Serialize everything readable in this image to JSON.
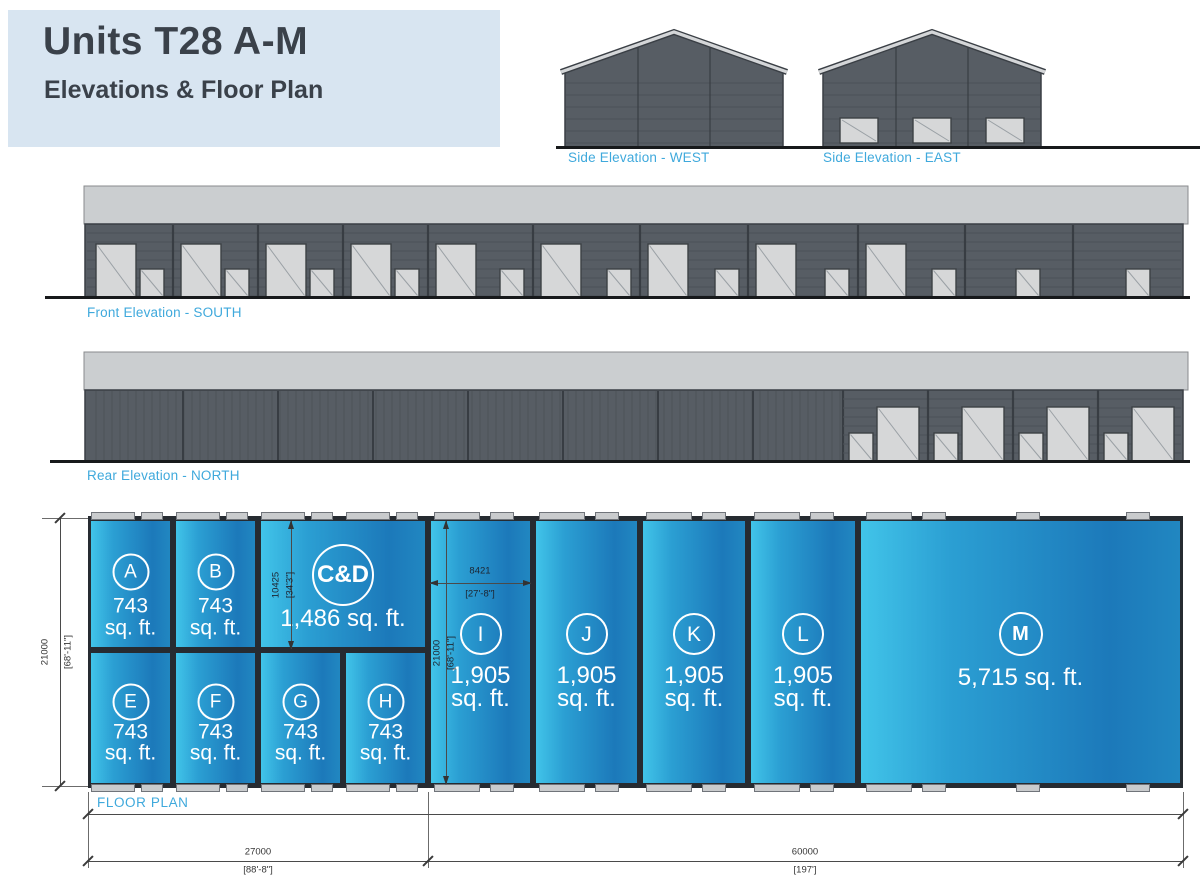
{
  "title": {
    "heading": "Units T28 A-M",
    "subheading": "Elevations & Floor Plan"
  },
  "elevations": {
    "side_west_label": "Side Elevation - WEST",
    "side_east_label": "Side Elevation - EAST",
    "front_label": "Front Elevation - SOUTH",
    "rear_label": "Rear Elevation - NORTH"
  },
  "floor_plan": {
    "label": "FLOOR PLAN",
    "units": [
      {
        "id": "A",
        "label": "A",
        "area": "743",
        "area2": "sq. ft."
      },
      {
        "id": "B",
        "label": "B",
        "area": "743",
        "area2": "sq. ft."
      },
      {
        "id": "CD",
        "label": "C&D",
        "area": "1,486 sq. ft."
      },
      {
        "id": "E",
        "label": "E",
        "area": "743",
        "area2": "sq. ft."
      },
      {
        "id": "F",
        "label": "F",
        "area": "743",
        "area2": "sq. ft."
      },
      {
        "id": "G",
        "label": "G",
        "area": "743",
        "area2": "sq. ft."
      },
      {
        "id": "H",
        "label": "H",
        "area": "743",
        "area2": "sq. ft."
      },
      {
        "id": "I",
        "label": "I",
        "area": "1,905",
        "area2": "sq. ft."
      },
      {
        "id": "J",
        "label": "J",
        "area": "1,905",
        "area2": "sq. ft."
      },
      {
        "id": "K",
        "label": "K",
        "area": "1,905",
        "area2": "sq. ft."
      },
      {
        "id": "L",
        "label": "L",
        "area": "1,905",
        "area2": "sq. ft."
      },
      {
        "id": "M",
        "label": "M",
        "area": "5,715 sq. ft."
      }
    ],
    "dimensions": {
      "left_height_mm": "21000",
      "left_height_ft": "[68'-11\"]",
      "cd_depth_mm": "10425",
      "cd_depth_ft": "[34'3\"]",
      "unit_i_width_mm": "8421",
      "unit_i_width_ft": "[27'-8\"]",
      "unit_i_height_mm": "21000",
      "unit_i_height_ft": "[68'-11\"]",
      "left_block_mm": "27000",
      "left_block_ft": "[88'-8\"]",
      "right_block_mm": "60000",
      "right_block_ft": "[197']"
    }
  },
  "colors": {
    "accent": "#3fa9dc",
    "title_bg": "#d8e5f1",
    "title_text": "#3a414a",
    "wall_mid": "#575d64",
    "wall_edge": "#3a3f45",
    "siding": "#4b5157",
    "joint": "#383d43",
    "fascia": "#cbced0",
    "fascia_edge": "#888b8e",
    "door_fill": "#d6d7d8",
    "door_edge": "#3c4145",
    "ground": "#17191b",
    "plan_wall": "#262b31",
    "plan_grad_start": "#41c4e9",
    "plan_grad_mid": "#2b9fd3",
    "plan_grad_end": "#1c79ba",
    "plan_grad_edge": "#2187c1"
  }
}
